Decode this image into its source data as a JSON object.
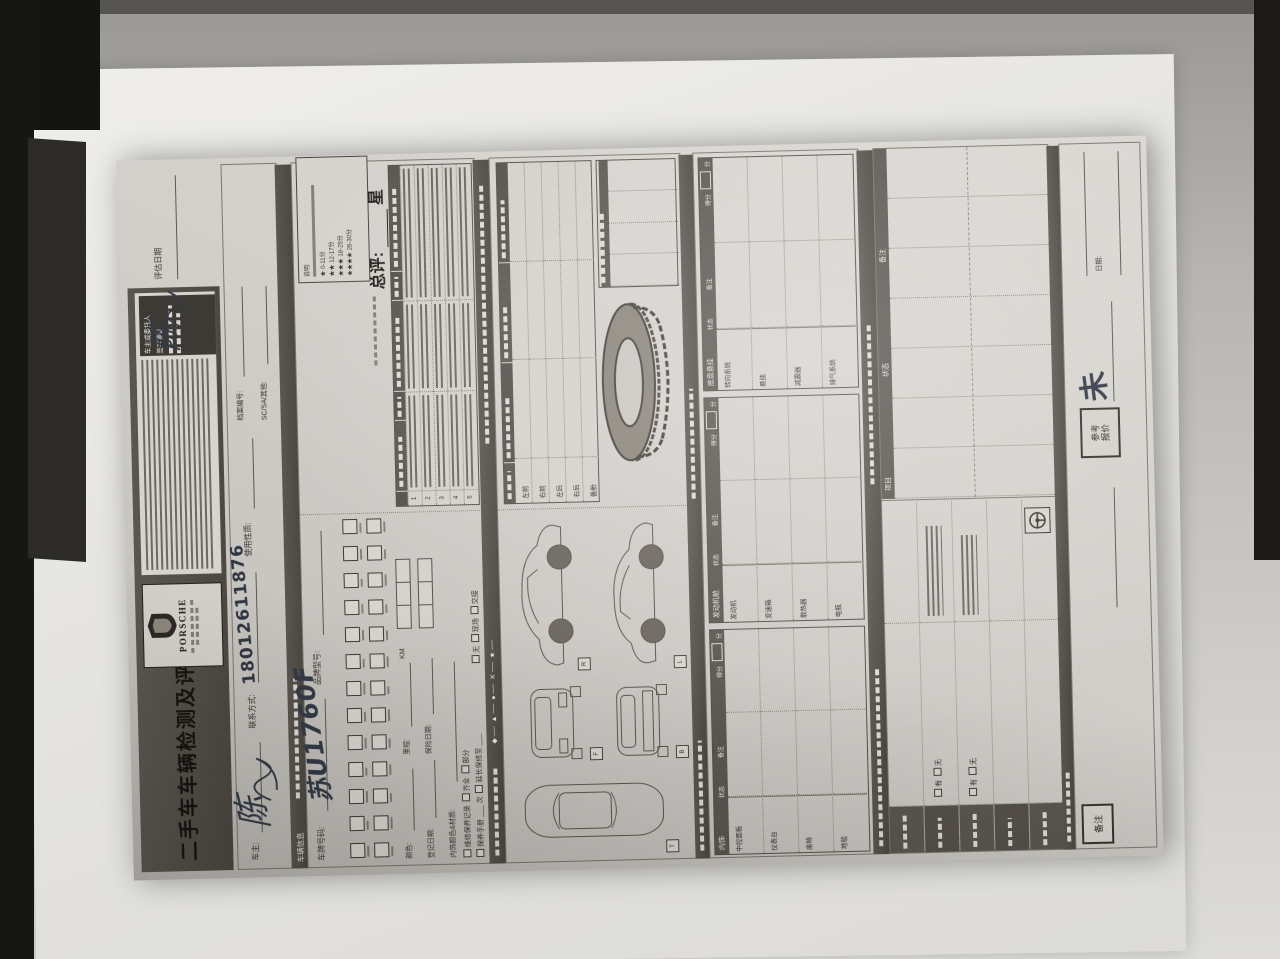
{
  "page": {
    "title": "二手车车辆检测及评估表",
    "brand_wordmark": "PORSCHE"
  },
  "header": {
    "terms_caption_line1": "车主或委托人",
    "terms_caption_line2": "签字确认",
    "eval_date_label": "评估日期"
  },
  "handwriting": {
    "owner_signature": "陈",
    "terms_signature": "陈",
    "phone": "18012611876",
    "plate": "苏U1760F",
    "not_yet": "未"
  },
  "client": {
    "owner_label": "车主:",
    "contact_label": "联系方式:",
    "usage_label": "使用性质:",
    "file_no_label": "档案编号:",
    "sc_sa_label": "SC/SA/其他:"
  },
  "vehicle": {
    "section_label": "车辆信息",
    "plate_label": "车牌号码:",
    "model_label": "品牌型号:",
    "color_label": "颜色:",
    "mileage_label": "里程:",
    "mileage_unit": "KM",
    "interior_label": "内饰颜色&材质:",
    "register_label": "登记日期:",
    "insurance_label": "保险日期:",
    "maintenance_opt1": "维修保养记录",
    "maintenance_opt2": "齐全",
    "maintenance_opt3": "部分",
    "manual_opt1": "保养手册",
    "manual_unit": "次",
    "manual_opt2": "延长保修至",
    "handover_opt1": "无",
    "handover_opt2": "现场",
    "handover_opt3": "交接"
  },
  "rating": {
    "legend_title": "说明:",
    "stars": [
      {
        "stars": "★",
        "range": "0-11分"
      },
      {
        "stars": "★★",
        "range": "12-17分"
      },
      {
        "stars": "★★★",
        "range": "18-25分"
      },
      {
        "stars": "★★★★",
        "range": "26-30分"
      }
    ],
    "overall_label": "总评:",
    "overall_unit": "星",
    "row_numbers": [
      "1",
      "2",
      "3",
      "4",
      "5"
    ]
  },
  "symbols": [
    "◆",
    "▲",
    "●",
    "✕",
    "★"
  ],
  "tires": {
    "rows": [
      "左前",
      "右前",
      "左后",
      "右后",
      "备胎"
    ]
  },
  "views": {
    "letters": [
      "R",
      "L",
      "F",
      "B",
      "T"
    ]
  },
  "mech": {
    "status_label": "状态",
    "remark_label": "备注",
    "score_label": "得分",
    "score_unit": "分",
    "sections": [
      {
        "name": "内饰",
        "rows": [
          "中控面板",
          "仪表台",
          "座椅",
          "地毯"
        ]
      },
      {
        "name": "发动机舱",
        "rows": [
          "发动机",
          "变速箱",
          "散热器",
          "电瓶"
        ]
      },
      {
        "name": "底盘悬挂",
        "rows": [
          "转向系统",
          "悬挂",
          "减震器",
          "排气系统"
        ]
      }
    ]
  },
  "roadtest": {
    "yes": "有",
    "no": "无"
  },
  "records": {
    "headers": [
      "项目",
      "状态",
      "备注"
    ]
  },
  "footer": {
    "remark_box": "备注",
    "price_box_line1": "参考",
    "price_box_line2": "报价",
    "date_label": "日期:"
  }
}
